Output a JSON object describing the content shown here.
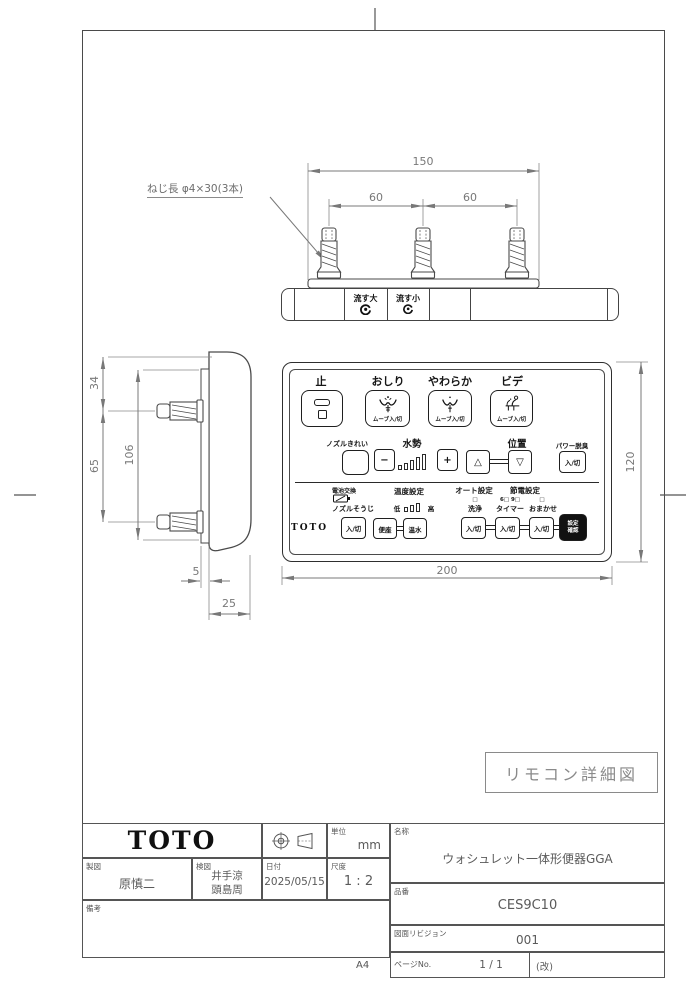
{
  "sheet": {
    "paper_size": "A4",
    "drawing_caption": "リモコン詳細図"
  },
  "dimensions": {
    "overall_width": "150",
    "screw_pitch_left": "60",
    "screw_pitch_right": "60",
    "face_width": "200",
    "face_height": "120",
    "top_offset": "34",
    "screw_pitch_side": "65",
    "plate_height": "106",
    "plate_thickness": "5",
    "body_depth": "25"
  },
  "notes": {
    "screw_note": "ねじ長 φ4×30(3本)"
  },
  "flush_panel": {
    "flush_large": "流す大",
    "flush_small": "流す小"
  },
  "remote": {
    "on_off": "入/切",
    "move": "ムーブ入/切",
    "brand": "TOTO",
    "row1": {
      "stop": "止",
      "rear": "おしり",
      "soft": "やわらか",
      "bidet": "ビデ"
    },
    "row2": {
      "nozzle_clean": "ノズルきれい",
      "water_pressure": "水勢",
      "minus": "−",
      "plus": "+",
      "position": "位置",
      "up": "△",
      "down": "▽",
      "power_deodorizer": "パワー脱臭"
    },
    "row3": {
      "battery": "電池交換",
      "temperature": "温度設定",
      "auto": "オート設定",
      "energy_save": "節電設定",
      "nozzle_wash": "ノズルそうじ",
      "low": "低",
      "high": "高",
      "seat": "便座",
      "warm_water": "温水",
      "wash": "洗浄",
      "timer": "タイマー",
      "auto_mode": "おまかせ",
      "indicator": "□",
      "timer_hours": "6□ 9□",
      "confirm_line1": "設定",
      "confirm_line2": "確認"
    }
  },
  "title_block": {
    "brand": "TOTO",
    "unit_label": "単位",
    "unit_value": "mm",
    "drafter_label": "製図",
    "drafter": "原慎二",
    "checker_label": "検図",
    "checker_line1": "井手涼",
    "checker_line2": "頭島周",
    "date_label": "日付",
    "date": "2025/05/15",
    "scale_label": "尺度",
    "scale": "1 : 2",
    "remarks_label": "備考",
    "name_label": "名称",
    "name": "ウォシュレット一体形便器GGA",
    "part_no_label": "品番",
    "part_no": "CES9C10",
    "revision_label": "図面リビジョン",
    "revision": "001",
    "page_label": "ページNo.",
    "page": "1 / 1",
    "page_suffix": "(改)"
  }
}
